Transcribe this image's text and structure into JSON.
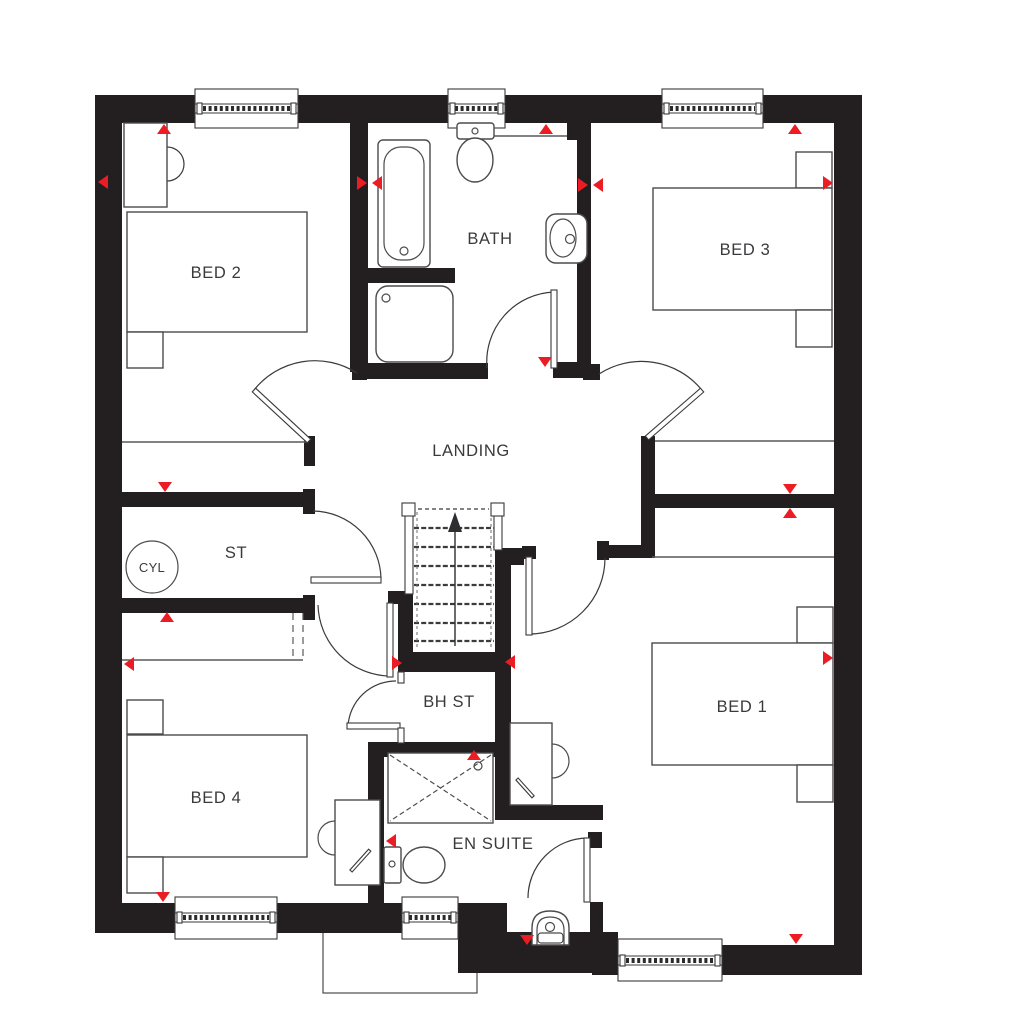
{
  "rooms": {
    "bed2": "BED 2",
    "bath": "BATH",
    "bed3": "BED 3",
    "landing": "LANDING",
    "st": "ST",
    "cyl": "CYL",
    "bed4": "BED 4",
    "bh_st": "BH ST",
    "en_suite": "EN SUITE",
    "bed1": "BED 1"
  },
  "colors": {
    "wall": "#231f20",
    "marker_red": "#ec1c24",
    "line": "#4b4b4d",
    "background": "#ffffff"
  }
}
